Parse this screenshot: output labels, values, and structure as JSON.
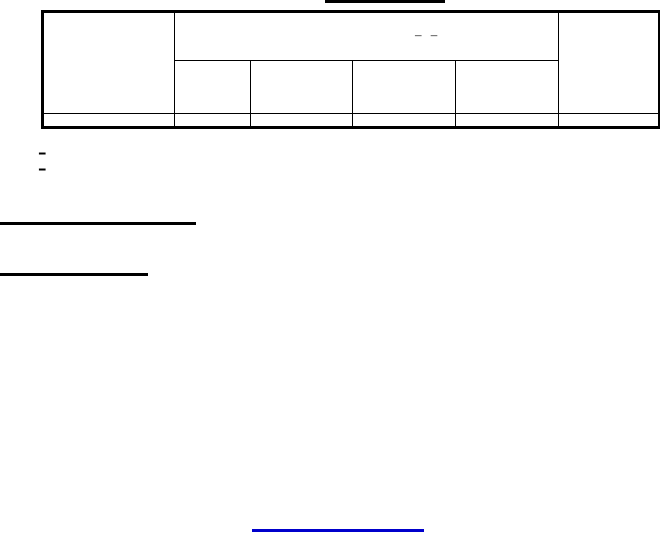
{
  "colors": {
    "background": "#ffffff",
    "rule": "#000000",
    "link_underline": "#0000cc"
  },
  "header_table": {
    "group_header_label": "– –",
    "column_count": 6,
    "subcolumn_count": 4,
    "body_row_count": 1
  },
  "footnote_markers": [
    "–",
    "–"
  ]
}
